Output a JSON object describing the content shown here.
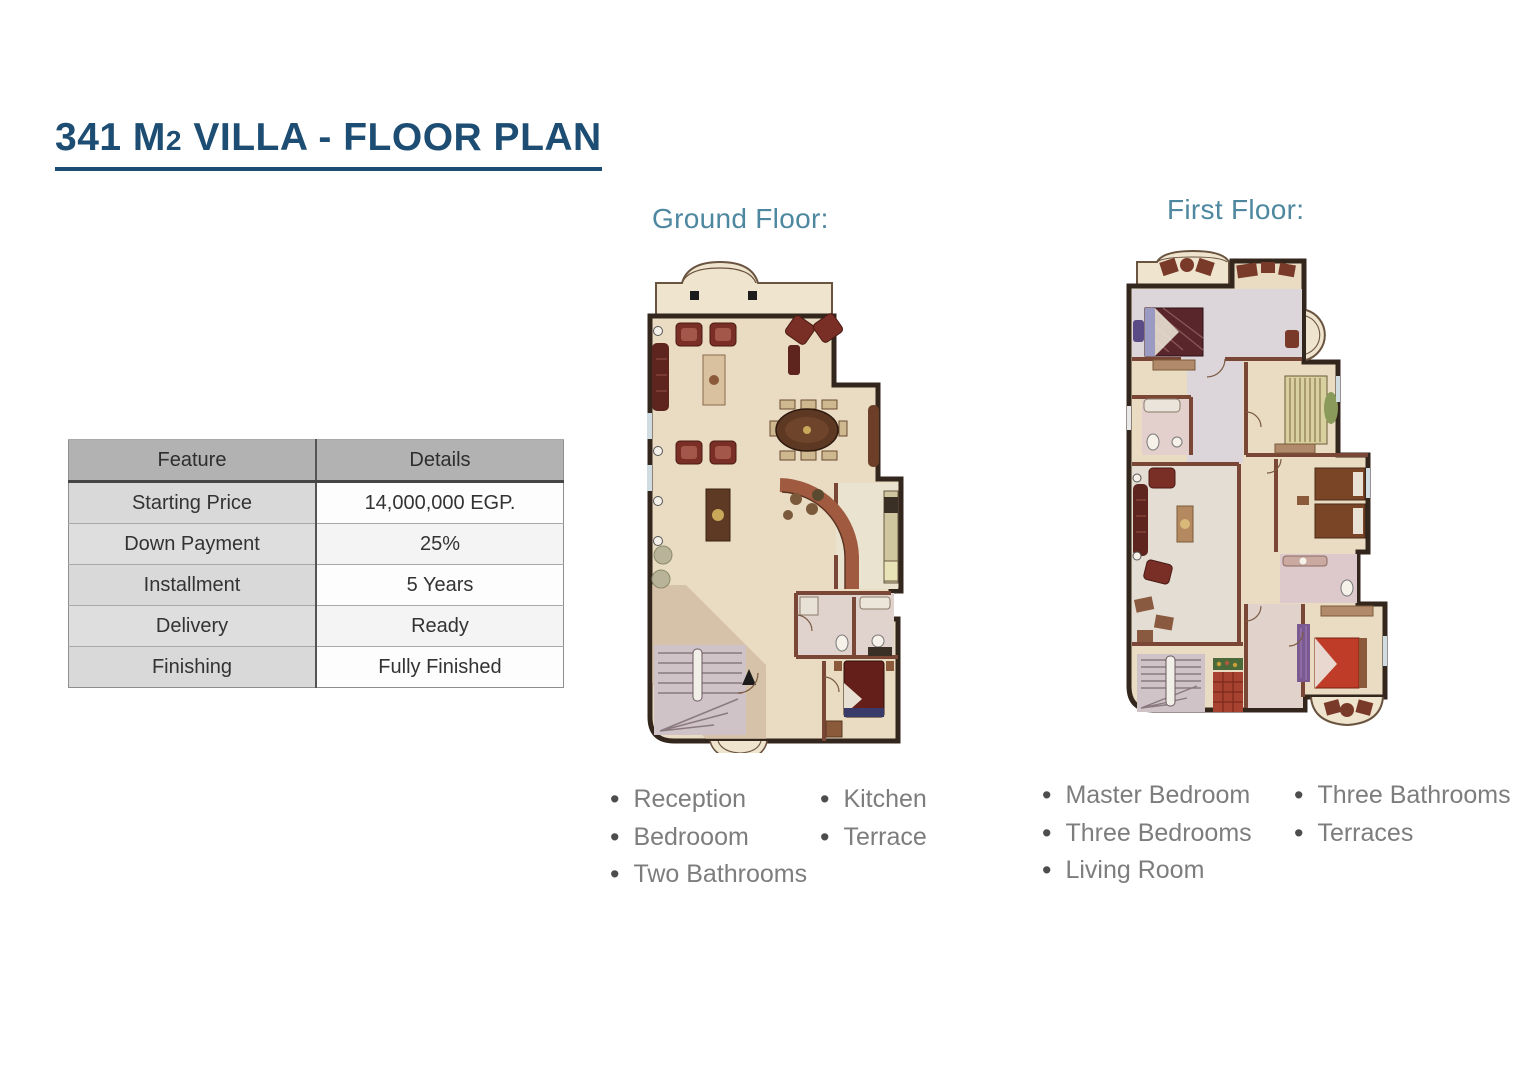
{
  "title": "341 M2 VILLA - FLOOR PLAN",
  "title_parts": {
    "pre": "341 M",
    "sub": "2",
    "post": " VILLA - FLOOR PLAN"
  },
  "table": {
    "headers": [
      "Feature",
      "Details"
    ],
    "rows": [
      {
        "feature": "Starting Price",
        "details": "14,000,000 EGP."
      },
      {
        "feature": "Down Payment",
        "details": "25%"
      },
      {
        "feature": "Installment",
        "details": "5 Years"
      },
      {
        "feature": "Delivery",
        "details": "Ready"
      },
      {
        "feature": "Finishing",
        "details": "Fully Finished"
      }
    ]
  },
  "ground_floor": {
    "label": "Ground Floor:",
    "features_col1": [
      "Reception",
      "Bedrooom",
      "Two Bathrooms"
    ],
    "features_col2": [
      "Kitchen",
      "Terrace"
    ]
  },
  "first_floor": {
    "label": "First Floor:",
    "features_col1": [
      "Master Bedroom",
      "Three Bedrooms",
      "Living Room"
    ],
    "features_col2": [
      "Three Bathrooms",
      "Terraces"
    ]
  },
  "colors": {
    "title_blue": "#1d4d72",
    "floor_label_teal": "#4d87a0",
    "bullet_text_gray": "#7d7d7d",
    "table_header_bg": "#b2b2b2",
    "table_feature_bg": "#d9d9d9",
    "floor_cream": "#e9dcc2",
    "wall_dark": "#33261c",
    "furniture_maroon": "#6e2a22"
  }
}
